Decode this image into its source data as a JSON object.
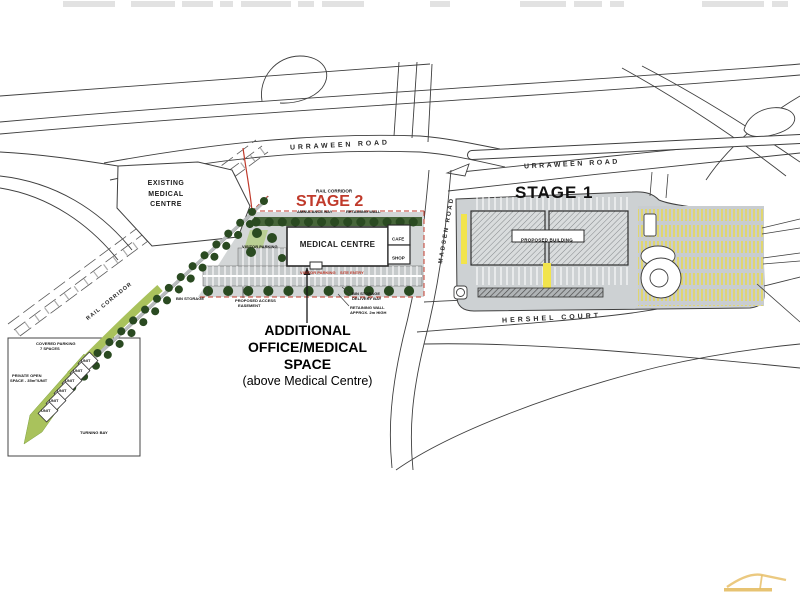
{
  "roads": {
    "urraween_west": "URRAWEEN ROAD",
    "urraween_east": "URRAWEEN ROAD",
    "madsen": "MADSEN ROAD",
    "hershel": "HERSHEL COURT",
    "rail_corridor": "RAIL CORRIDOR",
    "rail_corridor_small": "RAIL CORRIDOR"
  },
  "stage1": {
    "title": "STAGE 1",
    "building": "PROPOSED BUILDING"
  },
  "stage2": {
    "title": "STAGE 2",
    "building": "MEDICAL CENTRE",
    "cafe": "CAFE",
    "shop": "SHOP",
    "existing_line1": "EXISTING",
    "existing_line2": "MEDICAL",
    "existing_line3": "CENTRE",
    "ambulance_bay": "AMBULANCE BAY",
    "retaining_wall": "RETAINING WALL",
    "visitor_parking": "VISITOR PARKING",
    "entry_left": "VISITOR PARKING",
    "entry_right": "SITE ENTRY",
    "bin_storage": "BIN STORAGE",
    "easement_line1": "PROPOSED ACCESS",
    "easement_line2": "EASEMENT",
    "delivery_line1": "BIN STORAGE",
    "delivery_line2": "DELIVERY BAY",
    "retaining2_line1": "RETAINING WALL",
    "retaining2_line2": "APPROX. 2m HIGH"
  },
  "note": {
    "line1": "ADDITIONAL",
    "line2": "OFFICE/MEDICAL",
    "line3": "SPACE",
    "line4": "(above Medical Centre)"
  },
  "inset": {
    "unit": "UNIT",
    "covered_line1": "COVERED PARKING",
    "covered_line2": "7 SPACES",
    "open_line1": "PRIVATE OPEN",
    "open_line2": "SPACE - 35m²/UNIT",
    "turning_bay": "TURNING BAY"
  },
  "colors": {
    "stage2_red": "#c03a2b",
    "tree_green": "#2a4a21",
    "light_green": "#a9c25c",
    "road_gray": "#c6cacb",
    "highlight_yellow": "#f2e44c",
    "logo_gold": "#e7c06a"
  }
}
